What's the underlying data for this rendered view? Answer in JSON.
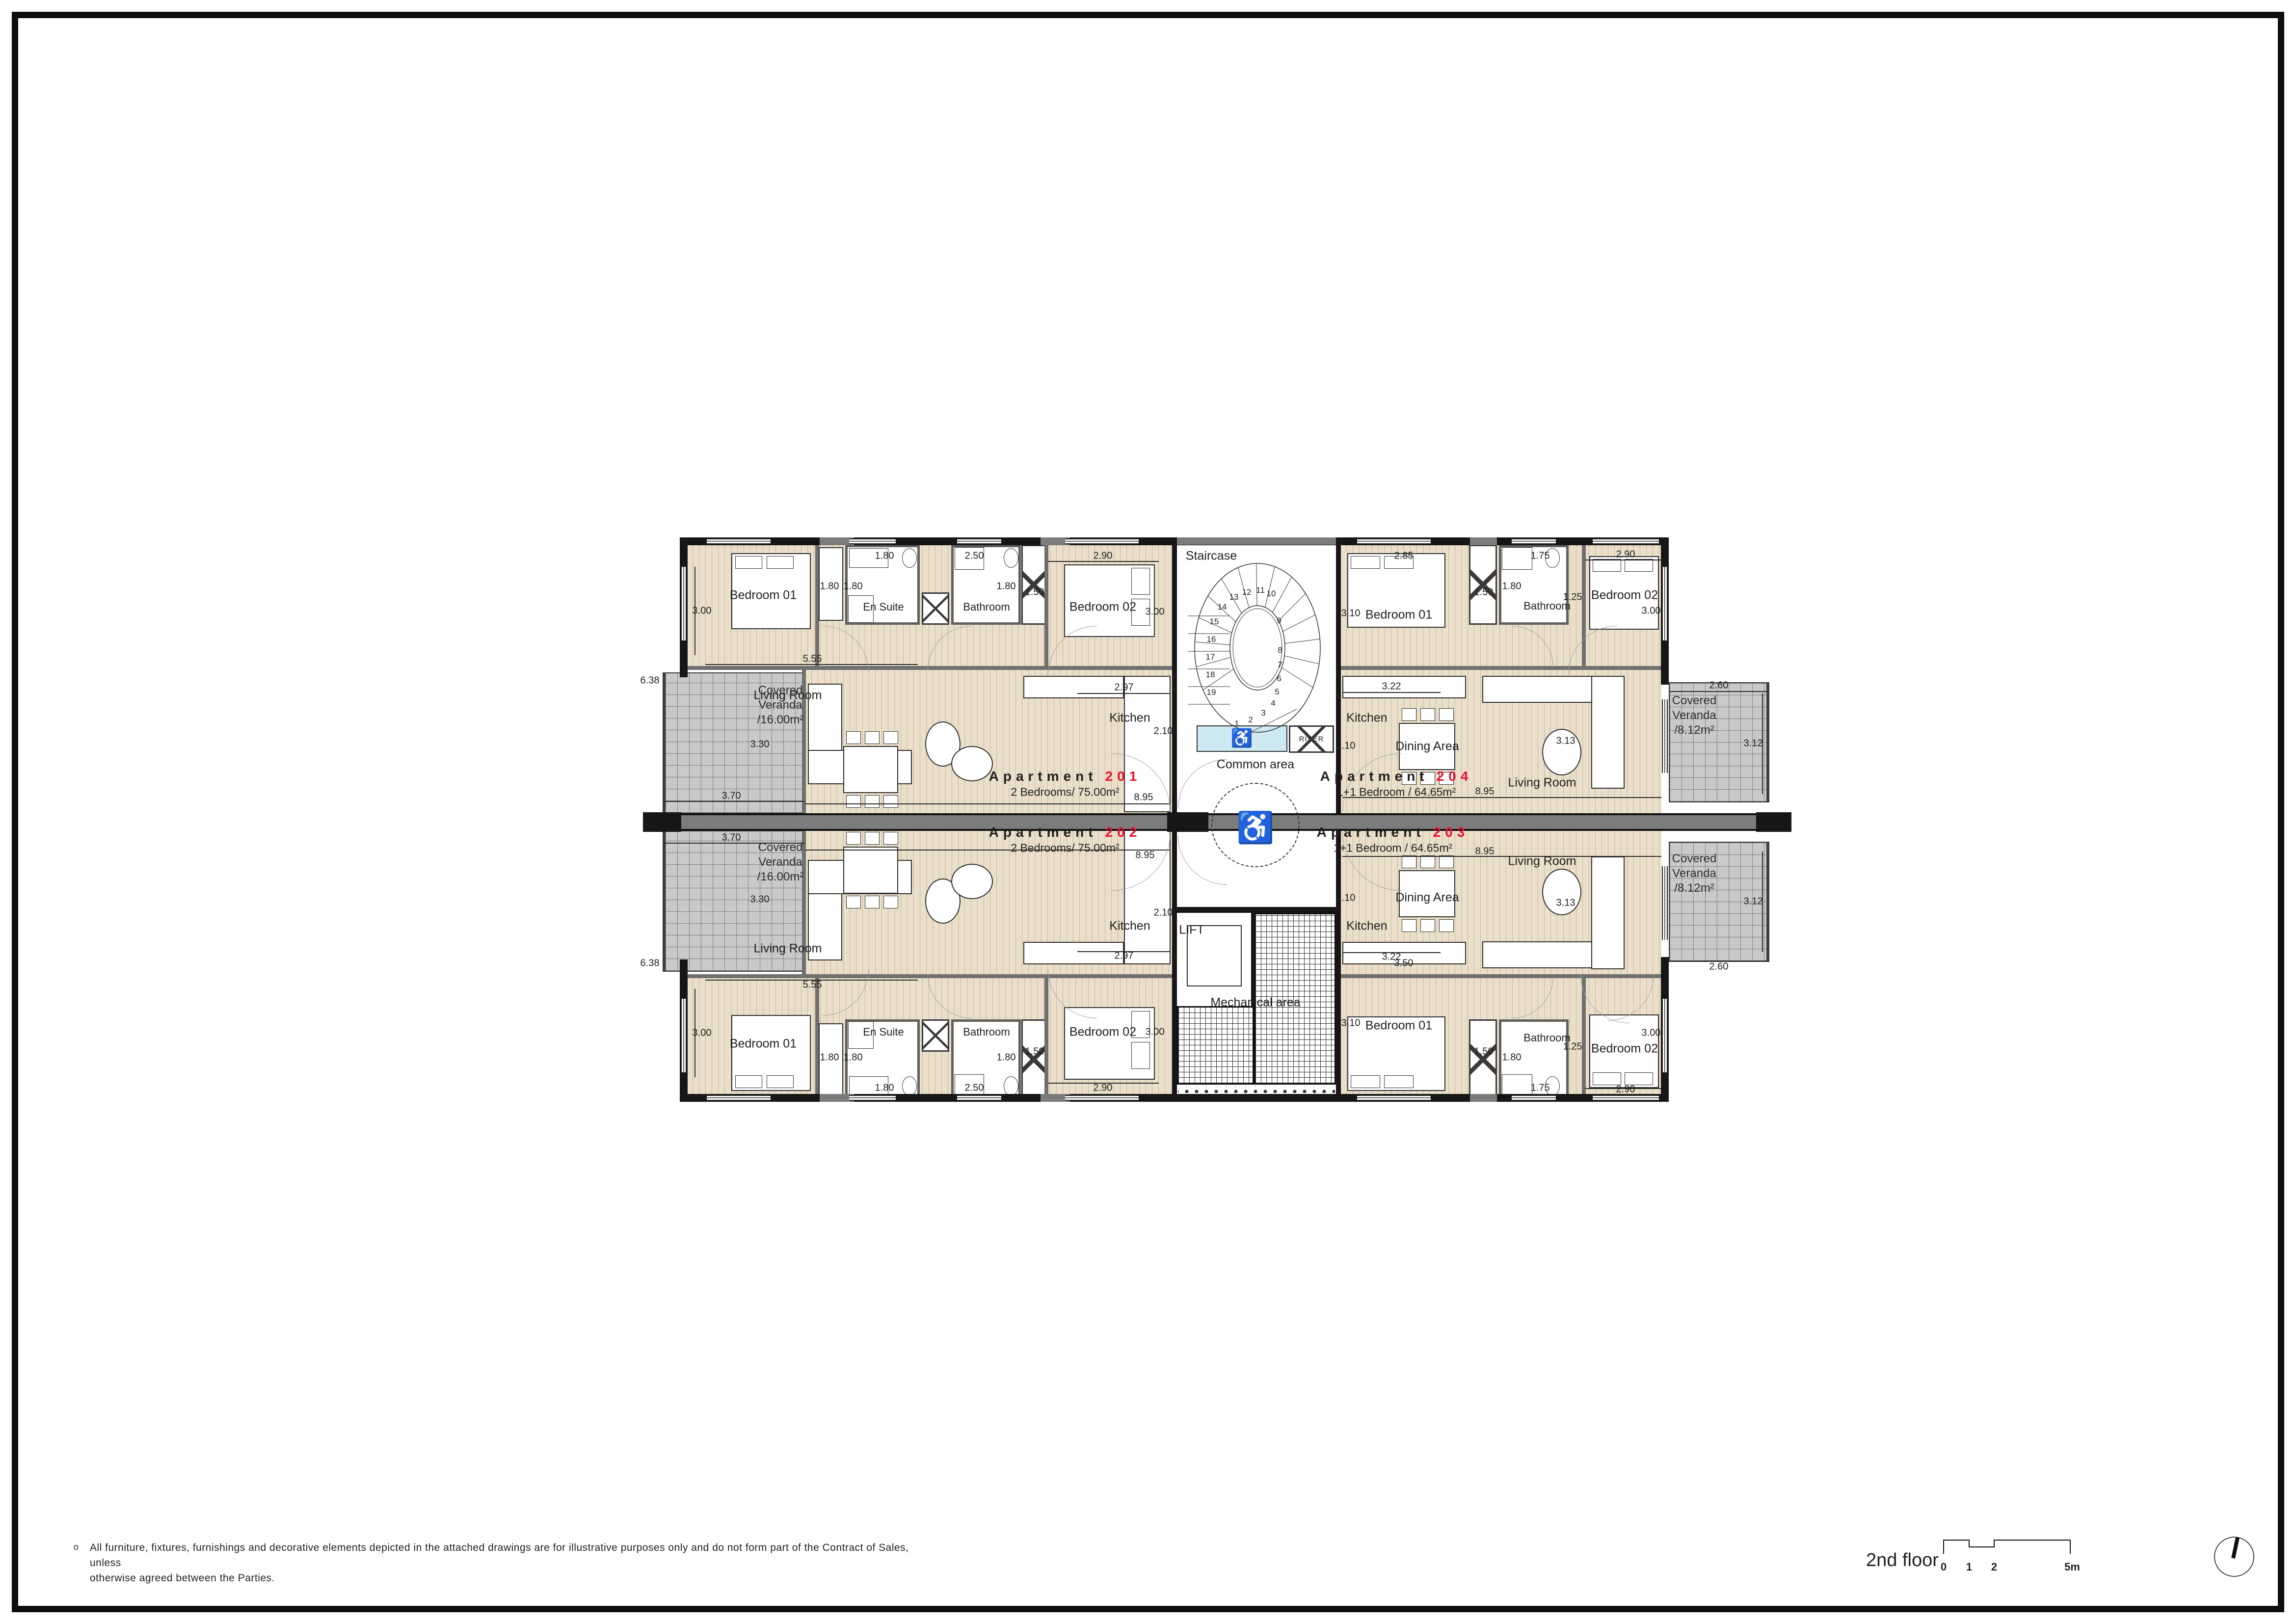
{
  "colors": {
    "accent_red": "#e8112d",
    "wall": "#161616",
    "gray_wall": "#7c7c7c",
    "floor": "#eadfca",
    "veranda": "#c9c9c9",
    "platform_blue": "#cfe9f3"
  },
  "core": {
    "staircase": "Staircase",
    "common": "Common area",
    "lift": "LIFT",
    "riser": "RISER",
    "mechanical": "Mechanical area",
    "wheelchair": "♿",
    "steps": [
      "1",
      "2",
      "3",
      "4",
      "5",
      "6",
      "7",
      "8",
      "9",
      "10",
      "11",
      "12",
      "13",
      "14",
      "15",
      "16",
      "17",
      "18",
      "19"
    ]
  },
  "rooms2br": {
    "bedroom1": "Bedroom 01",
    "ensuite": "En Suite",
    "bathroom": "Bathroom",
    "bedroom2": "Bedroom 02",
    "living": "Living Room",
    "kitchen": "Kitchen"
  },
  "rooms1br": {
    "bedroom1": "Bedroom 01",
    "bathroom": "Bathroom",
    "bedroom2": "Bedroom 02",
    "living": "Living Room",
    "kitchen": "Kitchen",
    "dining": "Dining Area"
  },
  "apt201": {
    "title": "Apartment",
    "number": "201",
    "subtitle": "2 Bedrooms/ 75.00m²"
  },
  "apt202": {
    "title": "Apartment",
    "number": "202",
    "subtitle": "2 Bedrooms/ 75.00m²"
  },
  "apt203": {
    "title": "Apartment",
    "number": "203",
    "subtitle": "1+1 Bedroom / 64.65m²"
  },
  "apt204": {
    "title": "Apartment",
    "number": "204",
    "subtitle": "1+1 Bedroom / 64.65m²"
  },
  "dims2br": {
    "bedroom1_h": "3.00",
    "bedroom1_w": "5.55",
    "wardrobe_a": "1.80",
    "wardrobe_b": "1.80",
    "ensuite_w": "1.80",
    "bathroom_w": "2.50",
    "bathroom_h": "1.80",
    "closet": "1.50",
    "bedroom2_w": "2.90",
    "bedroom2_h": "3.00",
    "living_h": "3.30",
    "kitchen_w": "2.97",
    "kitchen_h": "2.10",
    "apt_w": "8.95"
  },
  "dims1br": {
    "bedroom1_w_top": "2.85",
    "bedroom1_w_bottom": "3.50",
    "bedroom1_h": "3.10",
    "closet": "1.50",
    "bathroom_h": "1.80",
    "bathroom_w": "1.75",
    "entry_w": "1.25",
    "bedroom2_w": "2.90",
    "bedroom2_h": "3.00",
    "kitchen_w": "3.22",
    "kitchen_h": "2.10",
    "living_h": "3.13",
    "apt_w": "8.95"
  },
  "veranda_left": {
    "line1": "Covered",
    "line2": "Veranda",
    "area": "/16.00m²",
    "width": "3.70",
    "height": "6.38"
  },
  "veranda_right": {
    "line1": "Covered",
    "line2": "Veranda",
    "area": "/8.12m²",
    "width": "2.60",
    "height": "3.12"
  },
  "footer": {
    "bullet": "o",
    "line1": "All furniture, fixtures, furnishings and decorative elements depicted in the attached drawings are for illustrative purposes only and do not form part of the Contract of Sales, unless",
    "line2": "otherwise agreed between the Parties."
  },
  "titleblock": {
    "floor": "2nd floor",
    "scale_0": "0",
    "scale_1": "1",
    "scale_2": "2",
    "scale_5": "5m"
  }
}
